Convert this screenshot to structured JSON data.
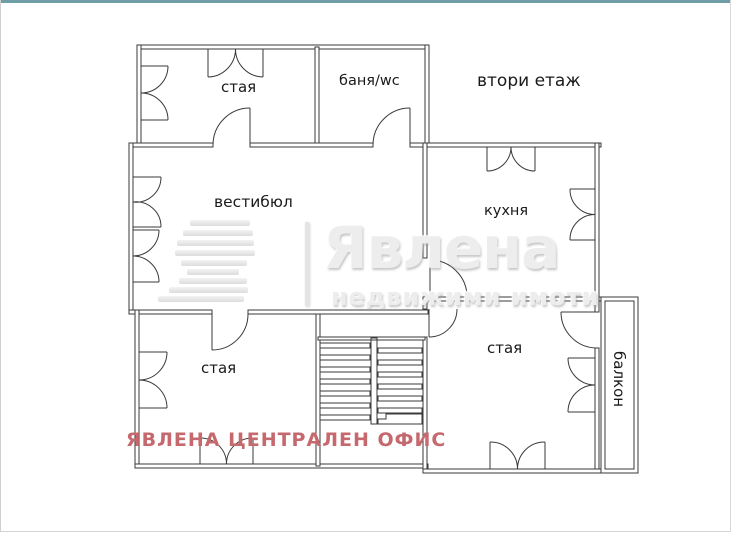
{
  "frame": {
    "top_bar_color": "#6f9da5"
  },
  "plan": {
    "floor_title": "втори етаж",
    "rooms": {
      "top_left": "стая",
      "bathroom": "баня/wc",
      "vestibule": "вестибюл",
      "kitchen": "кухня",
      "bottom_left": "стая",
      "bottom_right": "стая",
      "balcony": "балкон"
    }
  },
  "watermark": {
    "brand": "Явлена",
    "tagline": "недвижими имоти",
    "color": "#ededed"
  },
  "footer": {
    "office_label": "ЯВЛЕНА ЦЕНТРАЛЕН ОФИС",
    "color": "#c5696e"
  }
}
